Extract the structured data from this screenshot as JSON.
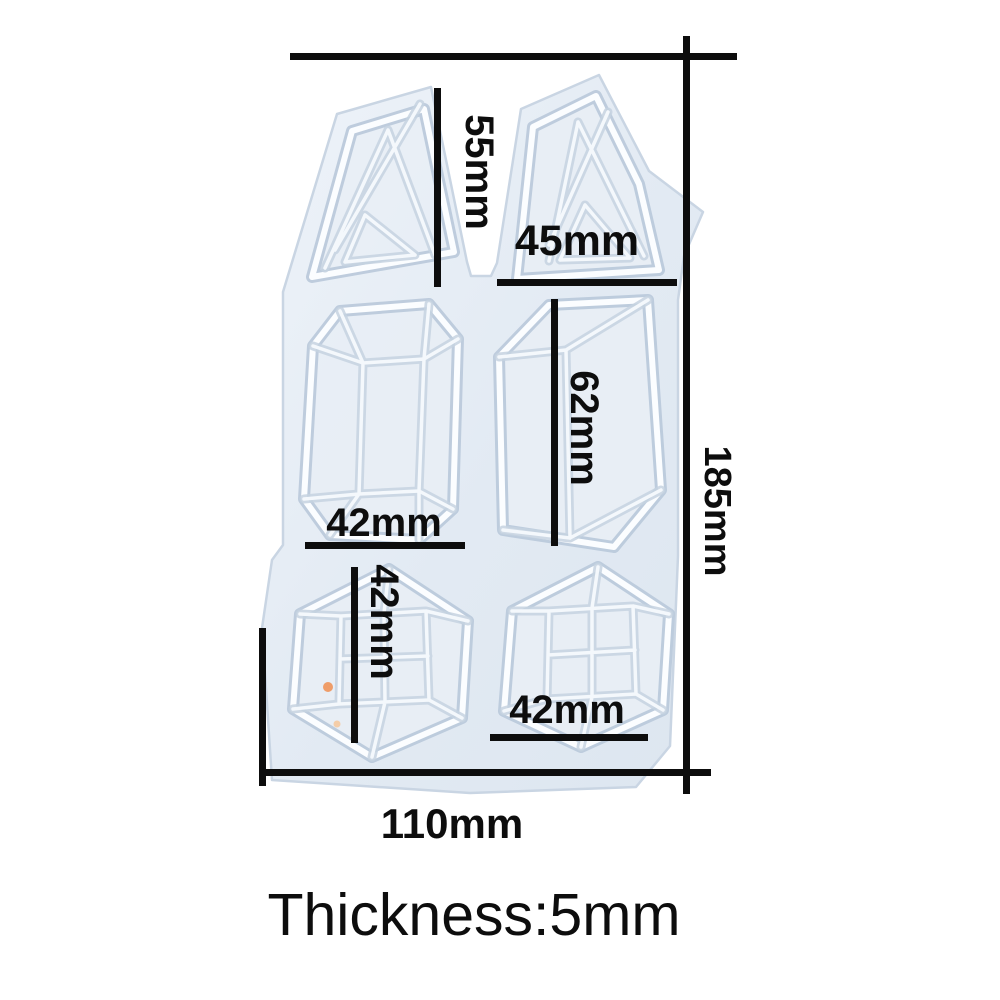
{
  "diagram": {
    "description": "dimension diagram of a white silicone gem resin mold with six cavities",
    "dimensions": {
      "triangle_left_height": "55mm",
      "triangle_right_width": "45mm",
      "prism_left_width": "42mm",
      "prism_right_height": "62mm",
      "cube_left_height": "42mm",
      "cube_right_width": "42mm",
      "overall_height": "185mm",
      "overall_width": "110mm"
    },
    "thickness_note": "Thickness:5mm",
    "colors": {
      "background": "#ffffff",
      "dimension_line": "#0d0d0d",
      "label_text": "#0d0d0d",
      "mold_body": "#e2eaf3",
      "mold_ridge_highlight": "#fbfdff",
      "mold_ridge_shadow": "#c6d2e1",
      "speck_orange": "#f0945a",
      "speck_orange_faint": "#f5c9a0"
    }
  }
}
